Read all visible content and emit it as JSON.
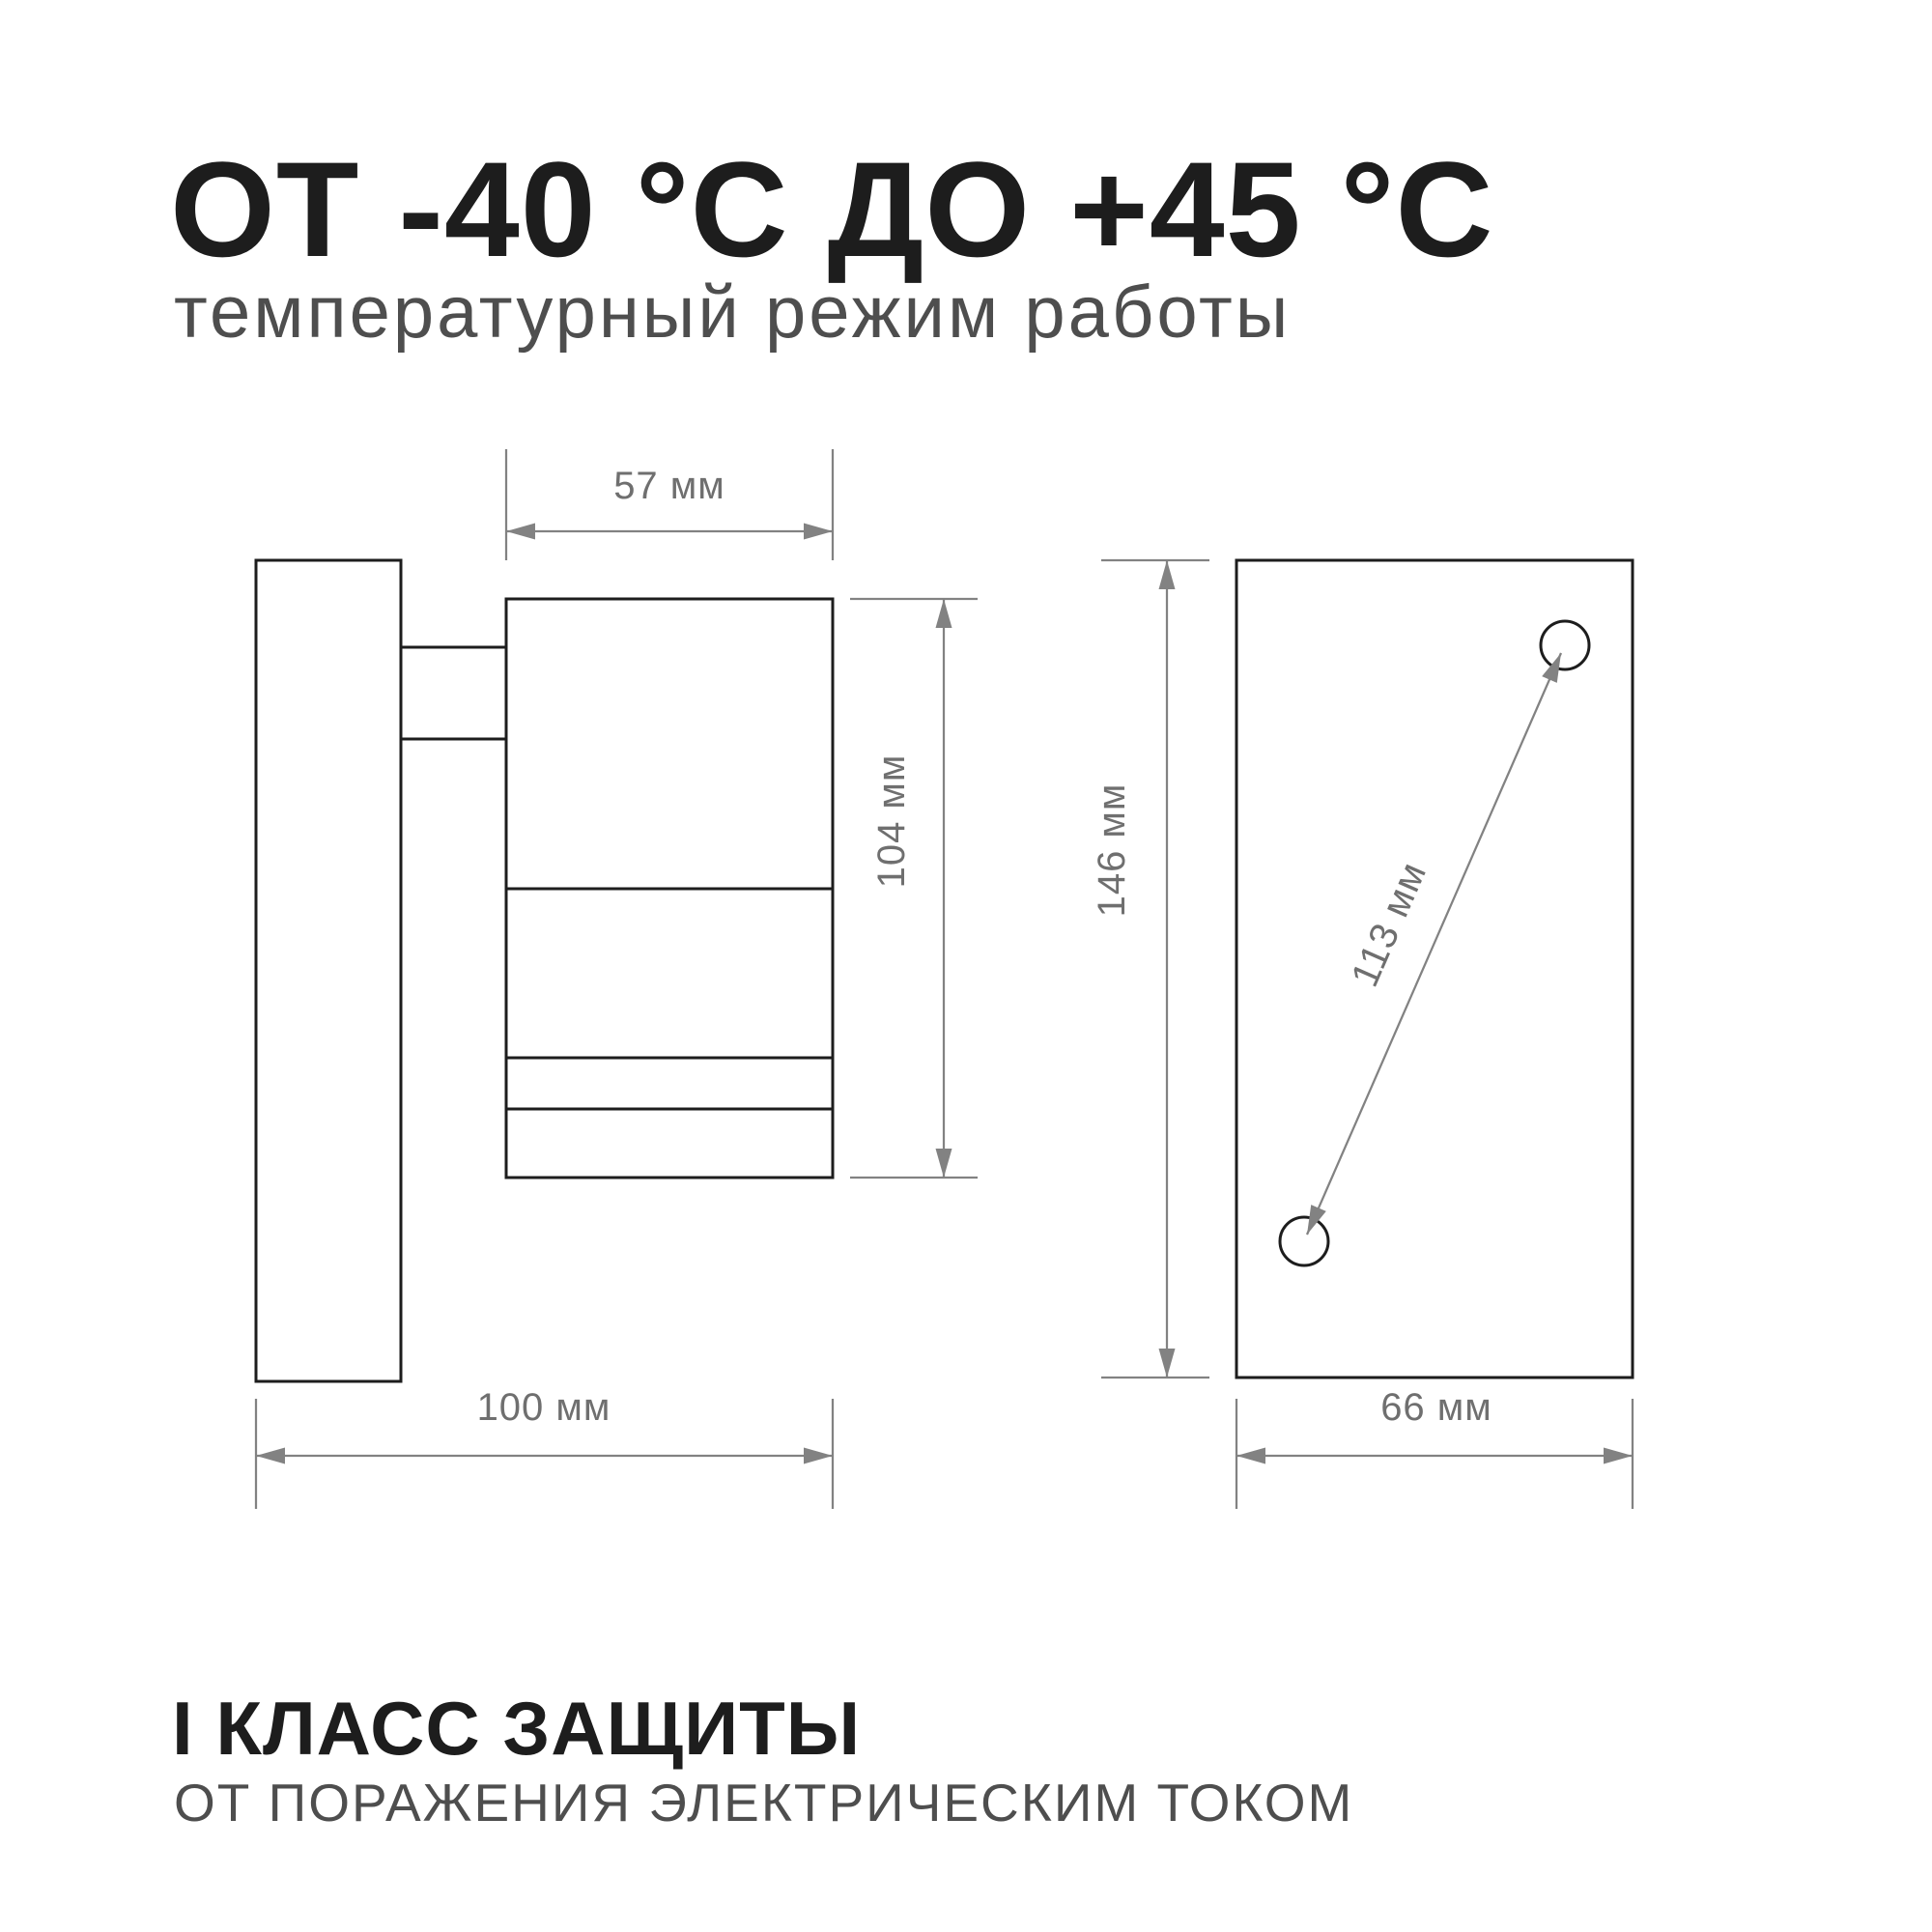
{
  "header": {
    "title": "ОТ -40 °С ДО +45 °С",
    "subtitle": "температурный режим работы"
  },
  "drawings": {
    "side_view": {
      "width_label": "57 мм",
      "height_label": "104 мм",
      "depth_label": "100 мм"
    },
    "back_plate": {
      "height_label": "146 мм",
      "width_label": "66 мм",
      "holes_label": "113 мм"
    }
  },
  "footer": {
    "title": "I КЛАСС ЗАЩИТЫ",
    "subtitle": "ОТ ПОРАЖЕНИЯ ЭЛЕКТРИЧЕСКИМ ТОКОМ"
  },
  "colors": {
    "ink": "#1d1d1d",
    "dim_line": "#828282",
    "dim_text": "#6f6f6f",
    "muted_text": "#4e4e4e",
    "background": "#ffffff"
  }
}
